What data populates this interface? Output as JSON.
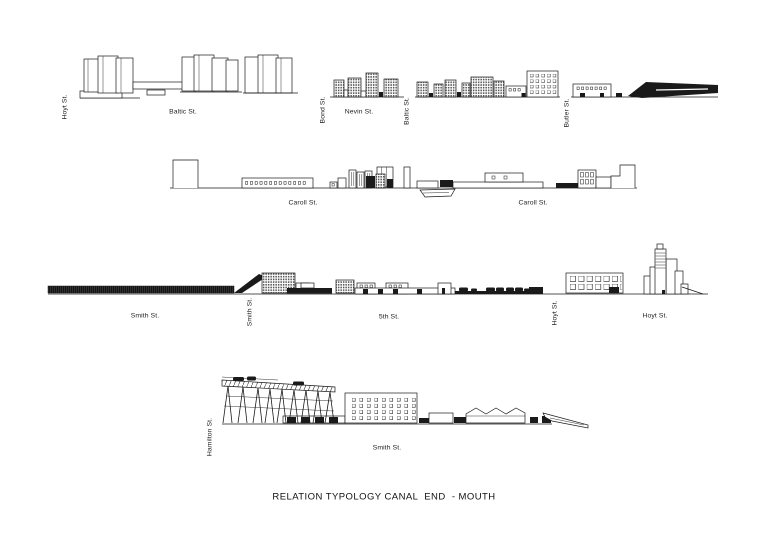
{
  "title": "RELATION TYPOLOGY CANAL  END  - MOUTH",
  "colors": {
    "ink": "#1a1a1a",
    "paper": "#ffffff"
  },
  "rows": [
    {
      "labels": {
        "hoyt_v": "Hoyt St.",
        "baltic_h": "Baltic St.",
        "bond_v": "Bond St.",
        "nevin_h": "Nevin St.",
        "baltic_v": "Baltic St.",
        "butler_v": "Butler St."
      }
    },
    {
      "labels": {
        "caroll_left": "Caroll St.",
        "caroll_right": "Caroll St."
      }
    },
    {
      "labels": {
        "smith_h": "Smith St.",
        "smith_v": "Smith St.",
        "fifth_h": "5th St.",
        "hoyt_v": "Hoyt St.",
        "hoyt_h": "Hoyt St."
      }
    },
    {
      "labels": {
        "hamilton_v": "Hamilton St.",
        "smith_h": "Smith St."
      }
    }
  ]
}
